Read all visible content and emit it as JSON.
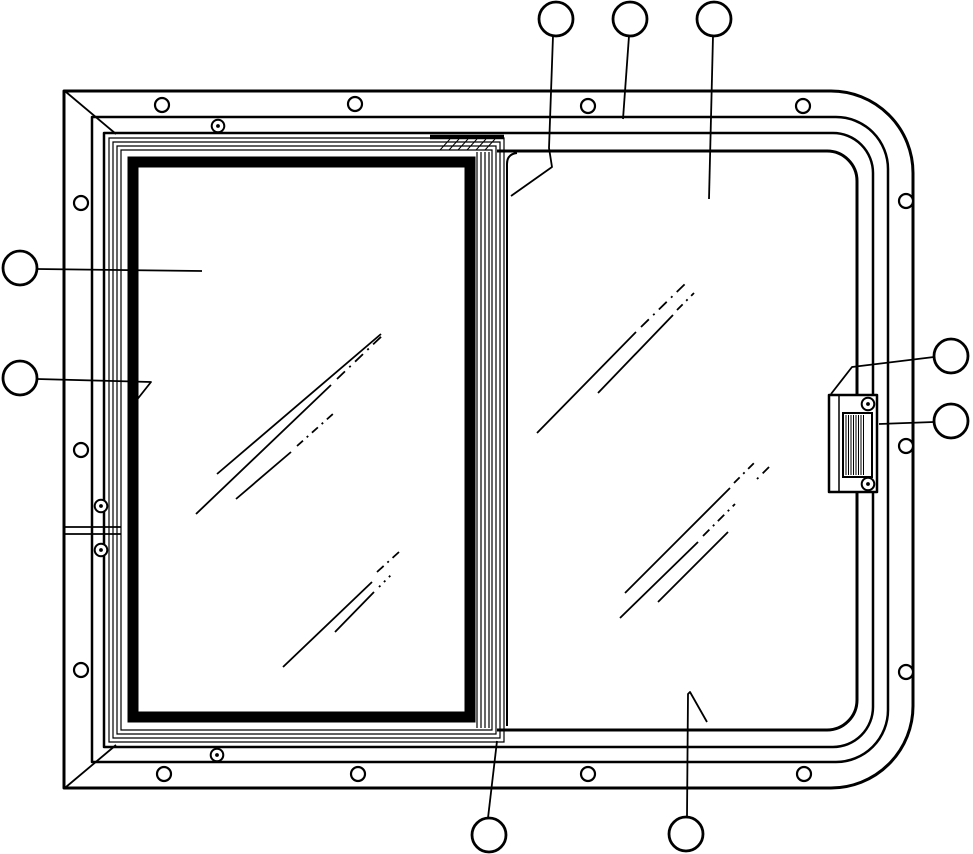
{
  "canvas": {
    "width": 973,
    "height": 854
  },
  "colors": {
    "line": "#000000",
    "background": "#ffffff"
  },
  "callouts": [
    {
      "id": "top-1",
      "cx": 556,
      "cy": 19,
      "r": 17,
      "leader": "M 553,36 L 549,148 L 552,167 L 511,196"
    },
    {
      "id": "top-2",
      "cx": 630,
      "cy": 19,
      "r": 17,
      "leader": "M 629,36 L 623,119"
    },
    {
      "id": "top-3",
      "cx": 714,
      "cy": 19,
      "r": 17,
      "leader": "M 713,36 L 709,199"
    },
    {
      "id": "left-1",
      "cx": 20,
      "cy": 268,
      "r": 17,
      "leader": "M 37,269 L 202,271"
    },
    {
      "id": "left-2",
      "cx": 20,
      "cy": 378,
      "r": 17,
      "leader": "M 37,379 L 151,382 L 132,406 L 131,381"
    },
    {
      "id": "right-1",
      "cx": 951,
      "cy": 356,
      "r": 17,
      "leader": "M 934,357 L 852,367 L 831,394"
    },
    {
      "id": "right-2",
      "cx": 951,
      "cy": 421,
      "r": 17,
      "leader": "M 934,422 L 879,424"
    },
    {
      "id": "bottom-1",
      "cx": 489,
      "cy": 835,
      "r": 17,
      "leader": "M 488,818 L 497,741"
    },
    {
      "id": "bottom-2",
      "cx": 686,
      "cy": 834,
      "r": 17,
      "leader": "M 687,817 L 688,694 L 690,692 L 707,722"
    }
  ],
  "flange_screw_holes": [
    [
      162,
      105
    ],
    [
      355,
      104
    ],
    [
      588,
      106
    ],
    [
      803,
      106
    ],
    [
      81,
      203
    ],
    [
      81,
      450
    ],
    [
      81,
      670
    ],
    [
      906,
      201
    ],
    [
      906,
      446
    ],
    [
      906,
      672
    ],
    [
      164,
      774
    ],
    [
      358,
      774
    ],
    [
      588,
      774
    ],
    [
      804,
      774
    ]
  ],
  "frame_screws": [
    [
      218,
      126
    ],
    [
      217,
      755
    ],
    [
      101,
      506
    ],
    [
      101,
      550
    ],
    [
      868,
      404
    ],
    [
      868,
      484
    ]
  ],
  "glass_reflections": [
    {
      "d": "M 217,474 L 381,334"
    },
    {
      "d": "M 196,514 L 331,385"
    },
    {
      "d": "M 337,379 L 385,333",
      "dash": "11 6 2 6"
    },
    {
      "d": "M 236,499 L 291,452"
    },
    {
      "d": "M 297,446 L 334,413",
      "dash": "8 5 2 5"
    },
    {
      "d": "M 283,667 L 372,582"
    },
    {
      "d": "M 377,572 L 399,552",
      "dash": "9 5 2 5"
    },
    {
      "d": "M 335,632 L 374,592"
    },
    {
      "d": "M 379,587 L 391,575",
      "dash": "2 5"
    },
    {
      "d": "M 537,433 L 636,332"
    },
    {
      "d": "M 641,327 L 688,281",
      "dash": "11 6 2 6"
    },
    {
      "d": "M 598,393 L 673,315"
    },
    {
      "d": "M 677,310 L 694,293",
      "dash": "8 5 2 5"
    },
    {
      "d": "M 625,593 L 730,488"
    },
    {
      "d": "M 734,483 L 755,462",
      "dash": "8 5 2 5"
    },
    {
      "d": "M 620,618 L 698,542"
    },
    {
      "d": "M 703,536 L 735,504",
      "dash": "9 5 2 5"
    },
    {
      "d": "M 658,602 L 728,532"
    },
    {
      "d": "M 757,479 L 770,466",
      "dash": "2 6 9 6"
    }
  ],
  "paths": {
    "frame_outer": "M 64,91 H 831 A 82,82 0 0 1 913,173 V 706 A 82,82 0 0 1 831,788 H 64 Z",
    "frame_line2": "M 92,117 H 836 A 52,52 0 0 1 888,169 V 710 A 52,52 0 0 1 836,762 H 92 Z",
    "frame_line3": "M 104,133 H 833 A 40,40 0 0 1 873,173 V 707 A 40,40 0 0 1 833,747 H 104 Z",
    "frame_line4": "M 497,151 H 827 A 30,30 0 0 1 857,181 V 700 A 30,30 0 0 1 827,730 H 497",
    "miter_top_left": "M 66,92 L 116,134",
    "miter_bottom_left": "M 66,787 L 116,745",
    "frame_joint": "M 65,527 H 121 M 65,534 H 121",
    "sash_r1": "M 109,138 H 504 V 742 H 109 Z",
    "sash_r2": "M 113,142 H 500 V 738 H 113 Z",
    "sash_r3": "M 117,146 H 496 V 734 H 117 Z",
    "sash_r4": "M 121,150 H 492 V 730 H 121 Z",
    "sash_band": "M 133,162 H 470 V 717 H 133 Z",
    "divider_lines": "M 477,152 V 728 M 481,152 V 728 M 485,152 V 728 M 489,152 V 728",
    "divider_band": "M 430,137 H 504",
    "divider_hatch": "M 440,150 L 450,139 M 449,150 L 459,139 M 458,150 L 468,139 M 467,150 L 477,139 M 476,150 L 486,139 M 485,150 L 495,139",
    "fixed_pane_edge": "M 517,153 Q 507,154 507,164 V 726",
    "latch_body": "M 829,395 H 877 V 492 H 829 Z",
    "latch_inner_line": "M 839,396 V 491",
    "latch_recess": "M 843,413 H 872 V 477 H 843 Z",
    "latch_ribs": "M 846,415 V 475 M 848.5,415 V 475 M 851,415 V 475 M 853.5,415 V 475 M 856,415 V 475 M 858.5,415 V 475 M 861,415 V 475 M 863.5,415 V 475"
  }
}
